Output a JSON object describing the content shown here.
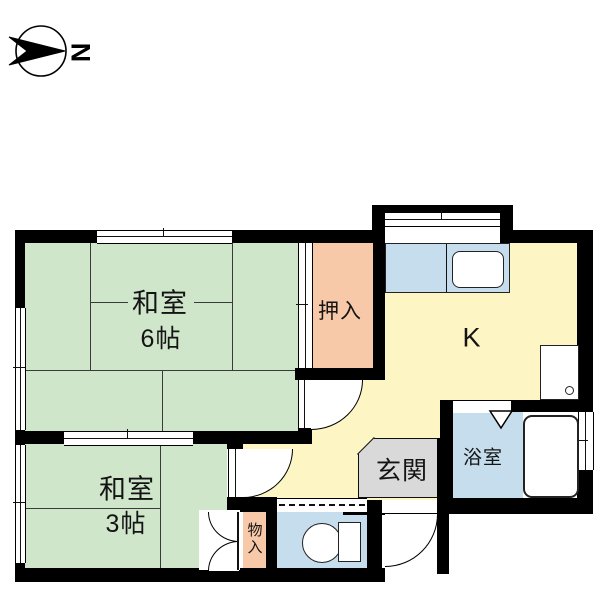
{
  "compass": {
    "north_label": "N"
  },
  "rooms": {
    "washitsu6": {
      "name": "和室",
      "size": "6帖"
    },
    "washitsu3": {
      "name": "和室",
      "size": "3帖"
    },
    "oshiire": {
      "label": "押入"
    },
    "kitchen": {
      "label": "K"
    },
    "genkan": {
      "label": "玄関"
    },
    "bathroom": {
      "label": "浴室"
    },
    "monoire": {
      "label": "物入"
    }
  },
  "colors": {
    "tatami_green": "#cfe6cb",
    "closet_pink": "#f8c9a9",
    "kitchen_yellow": "#fdf5c3",
    "water_blue": "#c6ddee",
    "entrance_gray": "#d9d9d9",
    "wall_black": "#000000"
  }
}
